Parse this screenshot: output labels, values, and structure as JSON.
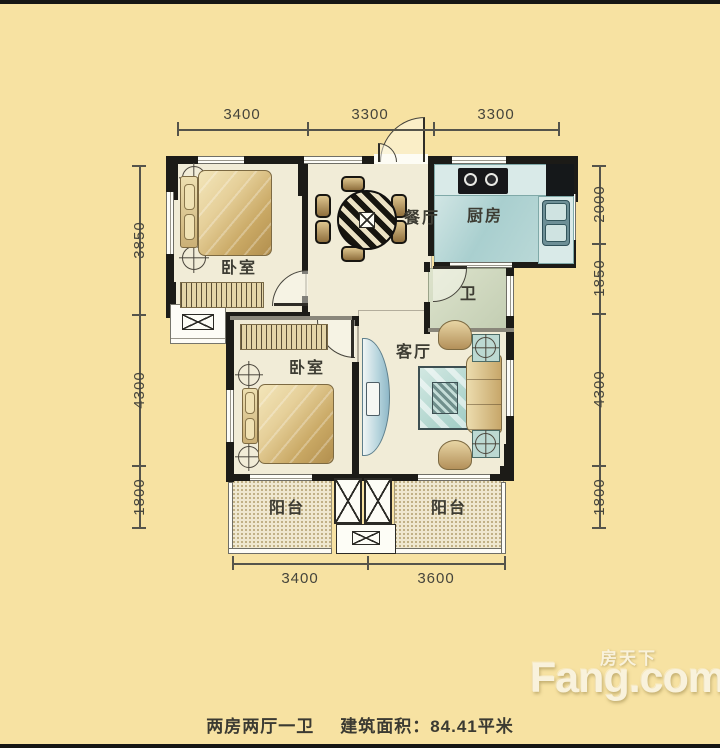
{
  "canvas": {
    "width": 720,
    "height": 748
  },
  "colors": {
    "background": "#f7e2a2",
    "frame_bar": "#161614",
    "wall": "#1c1b17",
    "floor": "#f1ecd7",
    "kitchen_floor": "#a9cfcf",
    "bath_floor": "#c2cdb2",
    "wood_furniture": "#c9a864",
    "teal_furniture": "#9fccc4",
    "dimension_text": "#46453c",
    "label_text": "#3d3c33",
    "logo_text": "#f9f2dc"
  },
  "rooms": {
    "bedroom1": "卧室",
    "bedroom2": "卧室",
    "dining": "餐厅",
    "kitchen": "厨房",
    "bath": "卫",
    "living": "客厅",
    "balcony_left": "阳台",
    "balcony_right": "阳台"
  },
  "dims": {
    "top": [
      "3400",
      "3300",
      "3300"
    ],
    "bottom": [
      "3400",
      "3600"
    ],
    "left": [
      "3850",
      "4300",
      "1800"
    ],
    "right": [
      "2000",
      "1850",
      "4300",
      "1800"
    ]
  },
  "caption": {
    "layout": "两房两厅一卫",
    "area": "建筑面积：84.41平米"
  },
  "logo": {
    "cn": "房天下",
    "en": "Fang.com"
  }
}
